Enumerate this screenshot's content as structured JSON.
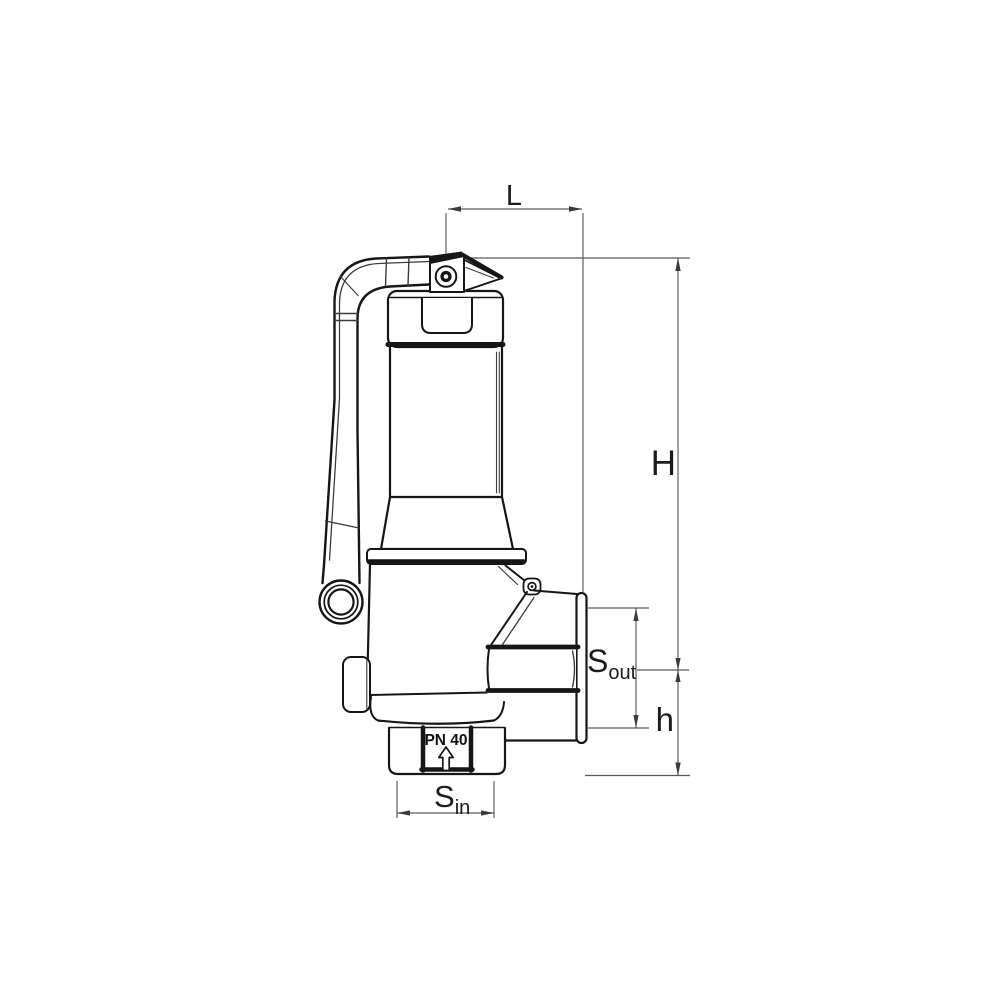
{
  "drawing": {
    "labels": {
      "length": "L",
      "total_height": "H",
      "outlet_center_height": "h",
      "outlet_wrench_base": "S",
      "outlet_wrench_sub": "out",
      "inlet_wrench_base": "S",
      "inlet_wrench_sub": "in"
    },
    "marking": {
      "pressure_rating": "PN 40"
    },
    "colors": {
      "background": "#ffffff",
      "outline": "#161616",
      "dimension": "#5a5a5a"
    }
  }
}
